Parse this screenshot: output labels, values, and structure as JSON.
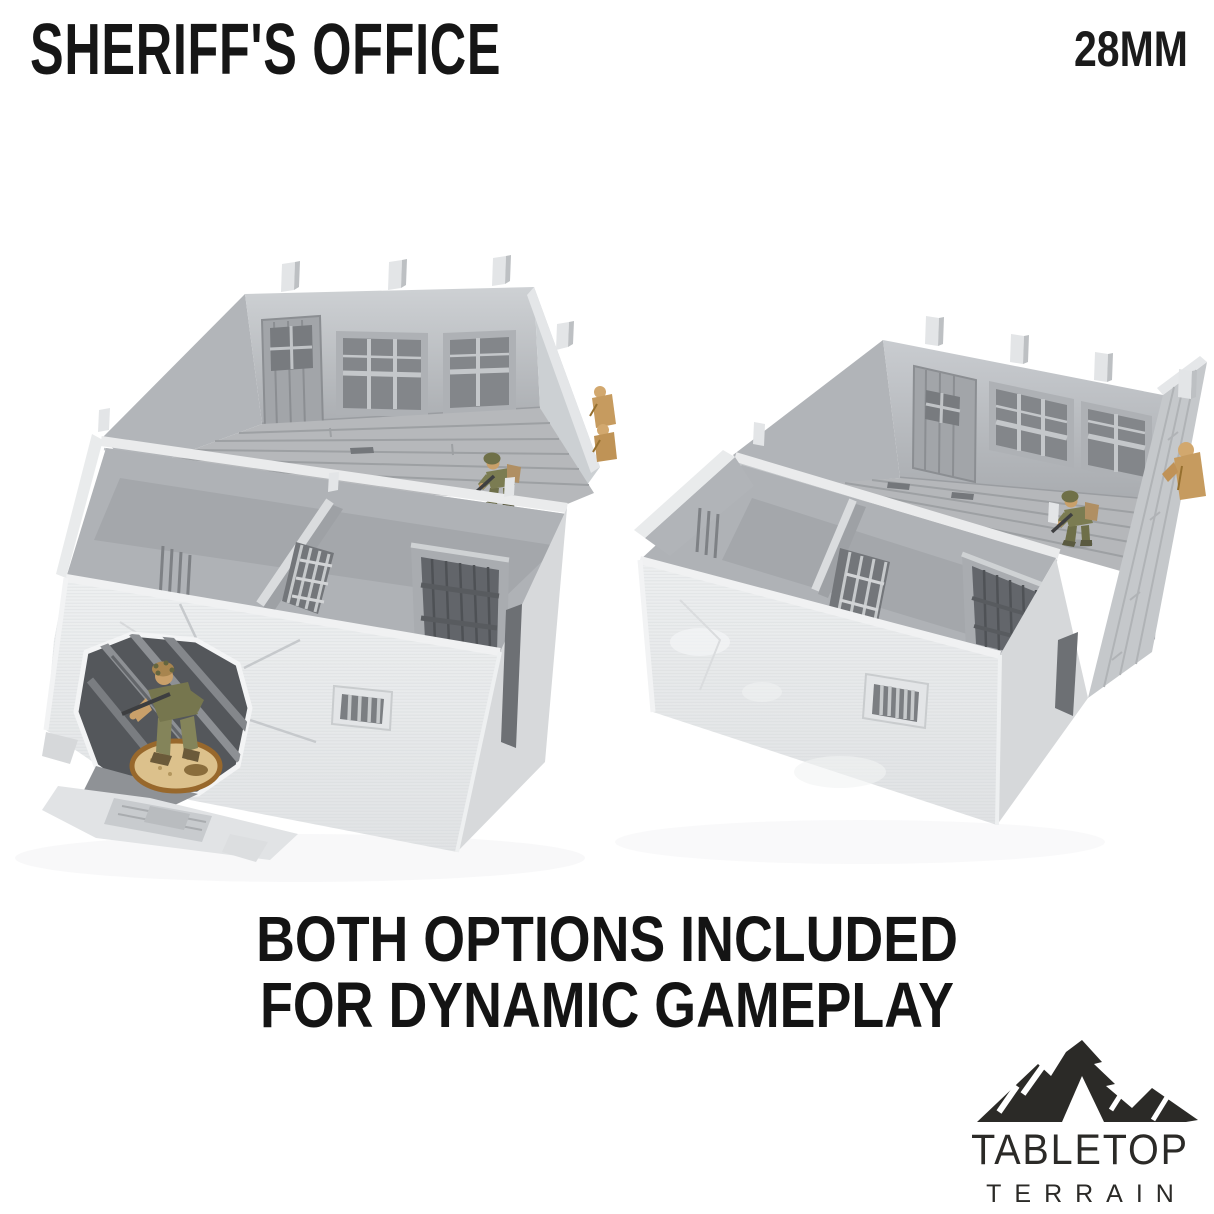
{
  "page": {
    "background_color": "#ffffff"
  },
  "header": {
    "title": "SHERIFF'S OFFICE",
    "scale_label": "28MM",
    "text_color": "#161616"
  },
  "caption": {
    "line1": "BOTH OPTIONS INCLUDED",
    "line2": "FOR DYNAMIC GAMEPLAY"
  },
  "brand": {
    "wordmark": "TABLETOP",
    "wordmark_sub": "TERRAIN",
    "icon": "mountain-icon",
    "color": "#2b2a27"
  },
  "photo": {
    "subject": "two 3d-printed sheriff's office terrain model variants, open-top with interior rooms",
    "left_variant": "building with breached front wall and rubble",
    "right_variant": "building with intact walls",
    "miniatures": "infantry figures on round base",
    "colors": {
      "print_grey": "#d9dbdd",
      "interior_grey": "#b7babd",
      "door_grey": "#63666b",
      "base_sand": "#dcc18c",
      "uniform_olive": "#76764e",
      "unpainted_gold": "#c69b5f"
    }
  }
}
